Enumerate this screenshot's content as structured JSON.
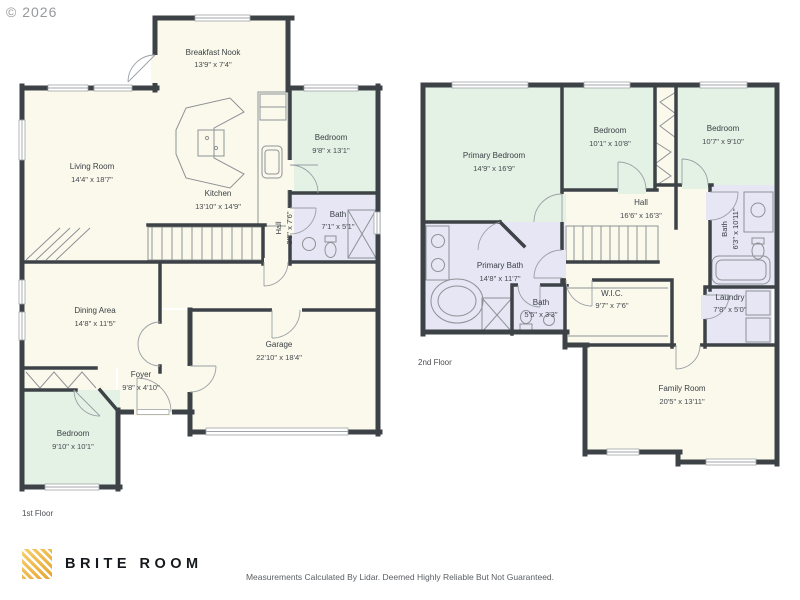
{
  "copyright": "© 2026",
  "footer": {
    "brand": "BRITE ROOM",
    "brand_icon": "striped-gold-square-logo-icon",
    "disclaimer": "Measurements Calculated By Lidar. Deemed Highly Reliable But Not Guaranteed."
  },
  "colors": {
    "wall": "#3d4247",
    "floor_fill": "#fbf9ec",
    "bedroom_fill": "#e4f1e5",
    "bath_fill": "#e6e6f4",
    "logo_gold": "#f3b537"
  },
  "floor1": {
    "label": "1st Floor",
    "rooms": {
      "nook": {
        "name": "Breakfast Nook",
        "dims": "13'9\" x 7'4\""
      },
      "living": {
        "name": "Living Room",
        "dims": "14'4\" x 18'7\""
      },
      "kitchen": {
        "name": "Kitchen",
        "dims": "13'10\" x 14'9\""
      },
      "bedroom1": {
        "name": "Bedroom",
        "dims": "9'8\" x 13'1\""
      },
      "bath1": {
        "name": "Bath",
        "dims": "7'1\" x 5'1\""
      },
      "hall": {
        "name": "Hall",
        "dims": "3'8\" x 7'6\""
      },
      "dining": {
        "name": "Dining Area",
        "dims": "14'8\" x 11'5\""
      },
      "foyer": {
        "name": "Foyer",
        "dims": "9'8\" x 4'10\""
      },
      "garage": {
        "name": "Garage",
        "dims": "22'10\" x 18'4\""
      },
      "bedroom2": {
        "name": "Bedroom",
        "dims": "9'10\" x 10'1\""
      }
    }
  },
  "floor2": {
    "label": "2nd Floor",
    "rooms": {
      "primary_bedroom": {
        "name": "Primary Bedroom",
        "dims": "14'9\" x 16'9\""
      },
      "bedroom3": {
        "name": "Bedroom",
        "dims": "10'1\" x 10'8\""
      },
      "bedroom4": {
        "name": "Bedroom",
        "dims": "10'7\" x 9'10\""
      },
      "hall": {
        "name": "Hall",
        "dims": "16'6\" x 16'3\""
      },
      "bath2": {
        "name": "Bath",
        "dims": "6'3\" x 10'11\""
      },
      "primary_bath": {
        "name": "Primary Bath",
        "dims": "14'8\" x 11'7\""
      },
      "bath3": {
        "name": "Bath",
        "dims": "5'5\" x 3'3\""
      },
      "wic": {
        "name": "W.I.C.",
        "dims": "9'7\" x 7'6\""
      },
      "laundry": {
        "name": "Laundry",
        "dims": "7'8\" x 5'0\""
      },
      "family_room": {
        "name": "Family Room",
        "dims": "20'5\" x 13'11\""
      }
    }
  }
}
